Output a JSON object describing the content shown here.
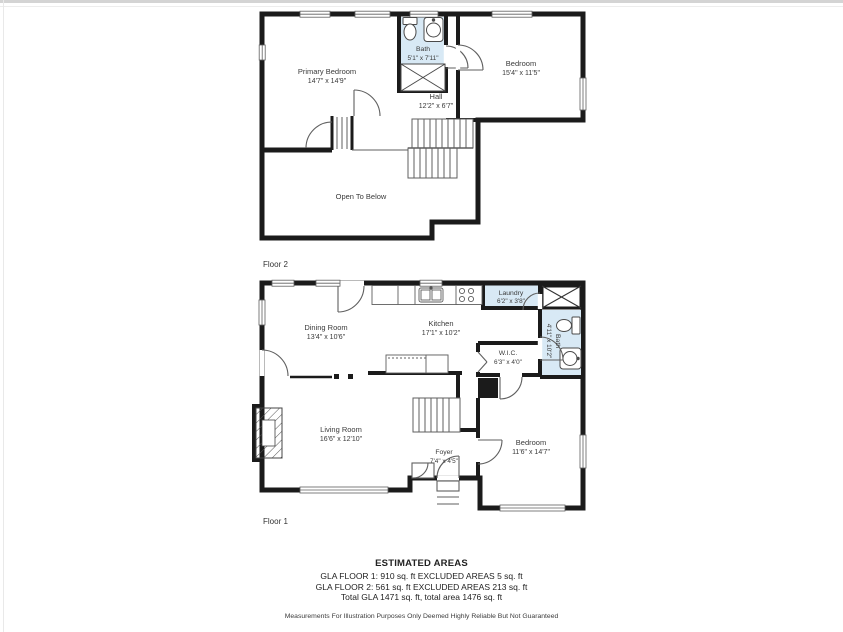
{
  "floor2": {
    "label": "Floor 2",
    "rooms": {
      "primary_bedroom": {
        "name": "Primary Bedroom",
        "dims": "14'7\" x 14'9\""
      },
      "bath": {
        "name": "Bath",
        "dims": "5'1\" x 7'11\""
      },
      "bedroom": {
        "name": "Bedroom",
        "dims": "15'4\" x 11'5\""
      },
      "hall": {
        "name": "Hall",
        "dims": "12'2\" x 6'7\""
      },
      "open_to_below": {
        "name": "Open To Below"
      }
    }
  },
  "floor1": {
    "label": "Floor 1",
    "rooms": {
      "dining_room": {
        "name": "Dining Room",
        "dims": "13'4\" x 10'6\""
      },
      "kitchen": {
        "name": "Kitchen",
        "dims": "17'1\" x 10'2\""
      },
      "laundry": {
        "name": "Laundry",
        "dims": "6'2\" x 3'8\""
      },
      "bath": {
        "name": "Bath",
        "dims": "4'11\" x 10'2\""
      },
      "wic": {
        "name": "W.I.C.",
        "dims": "6'3\" x 4'0\""
      },
      "living_room": {
        "name": "Living Room",
        "dims": "16'6\" x 12'10\""
      },
      "foyer": {
        "name": "Foyer",
        "dims": "7'4\" x 4'5\""
      },
      "bedroom": {
        "name": "Bedroom",
        "dims": "11'6\" x 14'7\""
      }
    }
  },
  "summary": {
    "title": "ESTIMATED AREAS",
    "line1": "GLA FLOOR 1: 910 sq. ft EXCLUDED AREAS 5 sq. ft",
    "line2": "GLA FLOOR 2: 561 sq. ft EXCLUDED AREAS 213 sq. ft",
    "line3": "Total GLA 1471 sq. ft, total area 1476 sq. ft",
    "disclaimer": "Measurements For Illustration Purposes Only Deemed Highly Reliable But Not Guaranteed"
  },
  "colors": {
    "wall": "#1b1b1b",
    "wet_area_fill": "#d8e9f5",
    "thin_line": "#5f5f5f",
    "text": "#3a3a3a"
  }
}
